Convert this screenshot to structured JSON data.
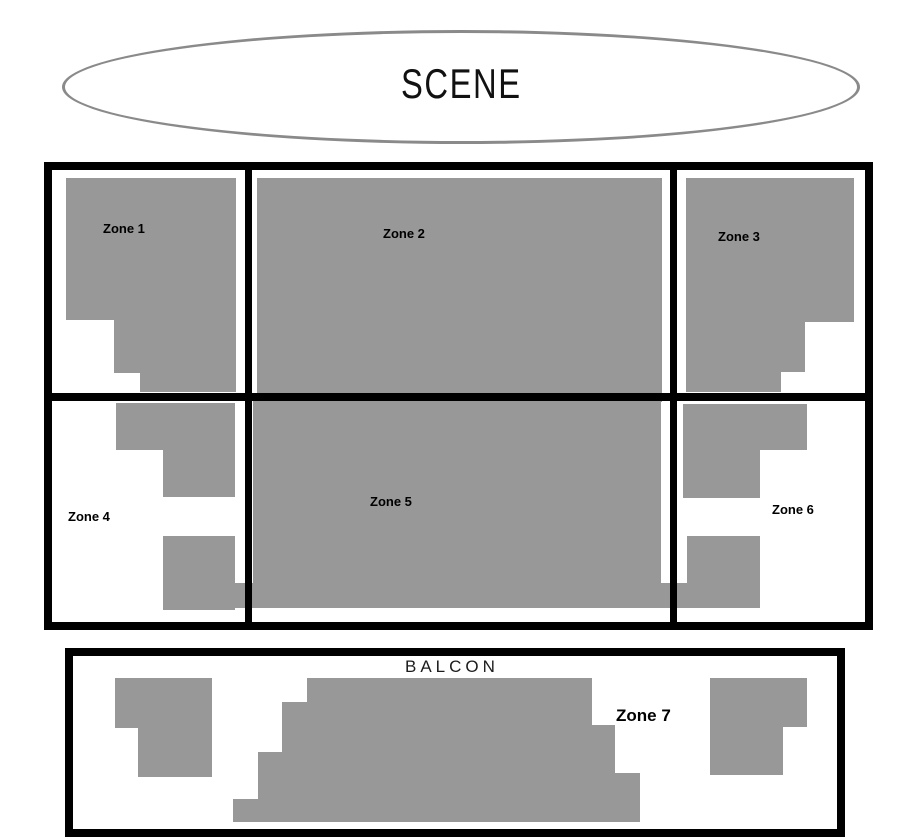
{
  "stage": {
    "label": "SCENE"
  },
  "hall": {
    "zones": [
      {
        "name": "Zone 1"
      },
      {
        "name": "Zone 2"
      },
      {
        "name": "Zone 3"
      },
      {
        "name": "Zone 4"
      },
      {
        "name": "Zone 5"
      },
      {
        "name": "Zone 6"
      }
    ]
  },
  "balcony": {
    "title": "BALCON",
    "zone": {
      "name": "Zone 7"
    }
  },
  "colors": {
    "seat_fill": "#989898",
    "outline": "#000000",
    "stage_outline": "#8a8a8a"
  }
}
